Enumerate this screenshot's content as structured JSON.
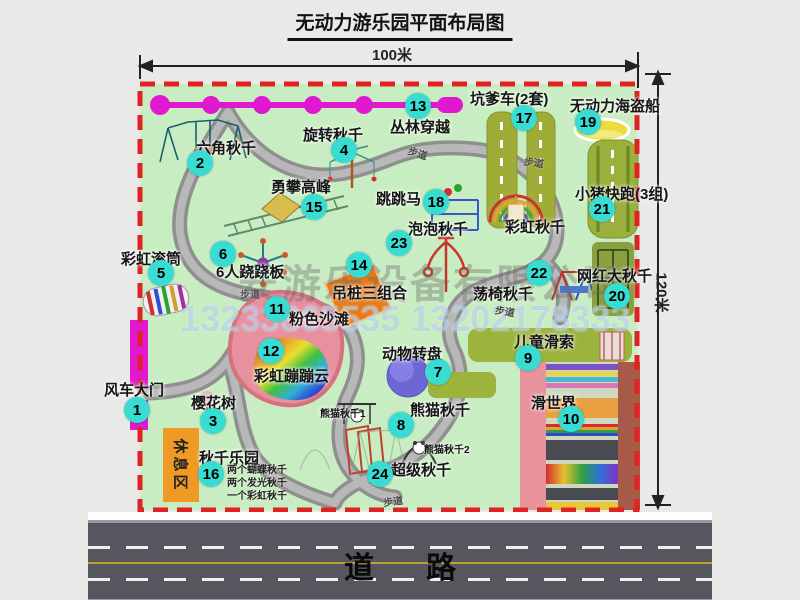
{
  "title": "无动力游乐园平面布局图",
  "dims": {
    "width": "100米",
    "height": "120米"
  },
  "road_label": "道路",
  "rest_area_label": "休息区",
  "path_label": "步道",
  "watermark": {
    "company": "安游乐设备有限公司",
    "phones": "13233865535 13202178333"
  },
  "colors": {
    "map_green": "#c9edc2",
    "border_red": "#e02222",
    "badge_cyan": "#38dcd2",
    "gate_magenta": "#e018d0",
    "road_gray": "#56565e",
    "rest_orange": "#f09a26"
  },
  "attractions": [
    {
      "num": "1",
      "label": "风车大门"
    },
    {
      "num": "2",
      "label": "六角秋千"
    },
    {
      "num": "3",
      "label": "樱花树"
    },
    {
      "num": "4",
      "label": "旋转秋千"
    },
    {
      "num": "5",
      "label": "彩虹滚筒"
    },
    {
      "num": "6",
      "label": "6人跷跷板"
    },
    {
      "num": "7",
      "label": "动物转盘"
    },
    {
      "num": "8",
      "label": "熊猫秋千"
    },
    {
      "num": "9",
      "label": "儿童滑索"
    },
    {
      "num": "10",
      "label": "滑世界"
    },
    {
      "num": "11",
      "label": "粉色沙滩"
    },
    {
      "num": "12",
      "label": "彩虹蹦蹦云"
    },
    {
      "num": "13",
      "label": "丛林穿越"
    },
    {
      "num": "14",
      "label": "吊桩三组合"
    },
    {
      "num": "15",
      "label": "勇攀高峰"
    },
    {
      "num": "16",
      "label": "秋千乐园"
    },
    {
      "num": "17",
      "label": "坑爹车(2套)"
    },
    {
      "num": "18",
      "label": "跳跳马"
    },
    {
      "num": "19",
      "label": "无动力海盗船"
    },
    {
      "num": "20",
      "label": "网红大秋千"
    },
    {
      "num": "21",
      "label": "小猪快跑(3组)"
    },
    {
      "num": "22",
      "label": "荡椅秋千"
    },
    {
      "num": "23",
      "label": "泡泡秋千"
    },
    {
      "num": "24",
      "label": "超级秋千"
    },
    {
      "num": "",
      "label": "彩虹秋千"
    }
  ],
  "notes": {
    "swing_park": [
      "两个蝴蝶秋千",
      "两个发光秋千",
      "一个彩虹秋千"
    ],
    "panda_1": "熊猫秋千1",
    "panda_2": "熊猫秋千2"
  }
}
